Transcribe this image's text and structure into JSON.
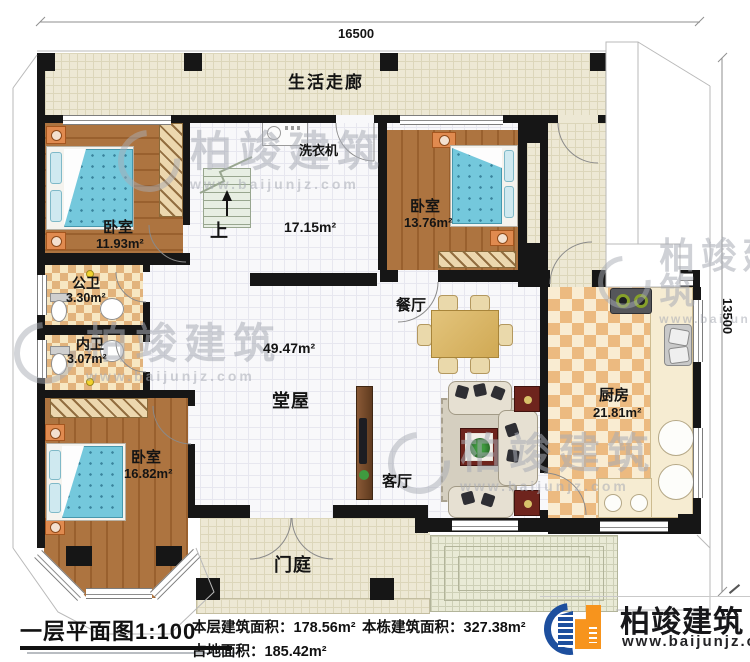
{
  "dimensions": {
    "top": "16500",
    "right": "13500"
  },
  "rooms": {
    "corridor": {
      "name": "生活走廊"
    },
    "bedroom1": {
      "name": "卧室",
      "area": "11.93m²"
    },
    "stair": {
      "up": "上",
      "washer": "洗衣机",
      "area": "17.15m²"
    },
    "bedroom2": {
      "name": "卧室",
      "area": "13.76m²"
    },
    "bath_public": {
      "name": "公卫",
      "area": "3.30m²"
    },
    "bath_inner": {
      "name": "内卫",
      "area": "3.07m²"
    },
    "bedroom3": {
      "name": "卧室",
      "area": "16.82m²"
    },
    "hall": {
      "name": "堂屋",
      "area": "49.47m²"
    },
    "dining": {
      "name": "餐厅"
    },
    "living": {
      "name": "客厅"
    },
    "kitchen": {
      "name": "厨房",
      "area": "21.81m²"
    },
    "porch": {
      "name": "门庭"
    }
  },
  "footer": {
    "title": "一层平面图1:100",
    "items": [
      {
        "label": "本层建筑面积：",
        "value": "178.56m²"
      },
      {
        "label": "本栋建筑面积：",
        "value": "327.38m²"
      },
      {
        "label": "占地面积：",
        "value": "185.42m²"
      }
    ]
  },
  "brand": {
    "name": "柏竣建筑",
    "url": "www.baijunjz.com"
  },
  "watermark": {
    "name": "柏竣建筑",
    "url": "www.baijunjz.com"
  },
  "colors": {
    "wall": "#161616",
    "brand_blue": "#1d4f9e",
    "brand_orange": "#f7941d",
    "bed": "#74c8dc"
  }
}
